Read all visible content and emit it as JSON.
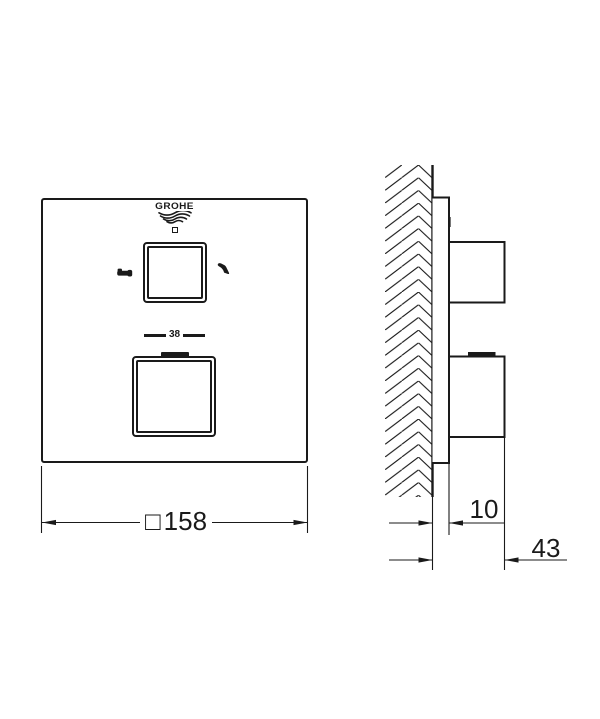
{
  "drawing": {
    "kind": "technical dimension drawing",
    "logo": {
      "text": "GROHE"
    },
    "front_view": {
      "temperature_scale": {
        "label": "38"
      },
      "width_dimension": {
        "symbol": "□",
        "value": "158"
      }
    },
    "side_view": {
      "plate_depth_dimension": {
        "value": "10"
      },
      "knob_depth_dimension": {
        "value": "43"
      }
    },
    "icons": {
      "diverter_left": "bath-spout-icon",
      "diverter_right": "hand-shower-icon",
      "logo_waves": "grohe-wave-icon"
    },
    "colors": {
      "ink": "#1a1a1a",
      "background": "#ffffff"
    }
  }
}
